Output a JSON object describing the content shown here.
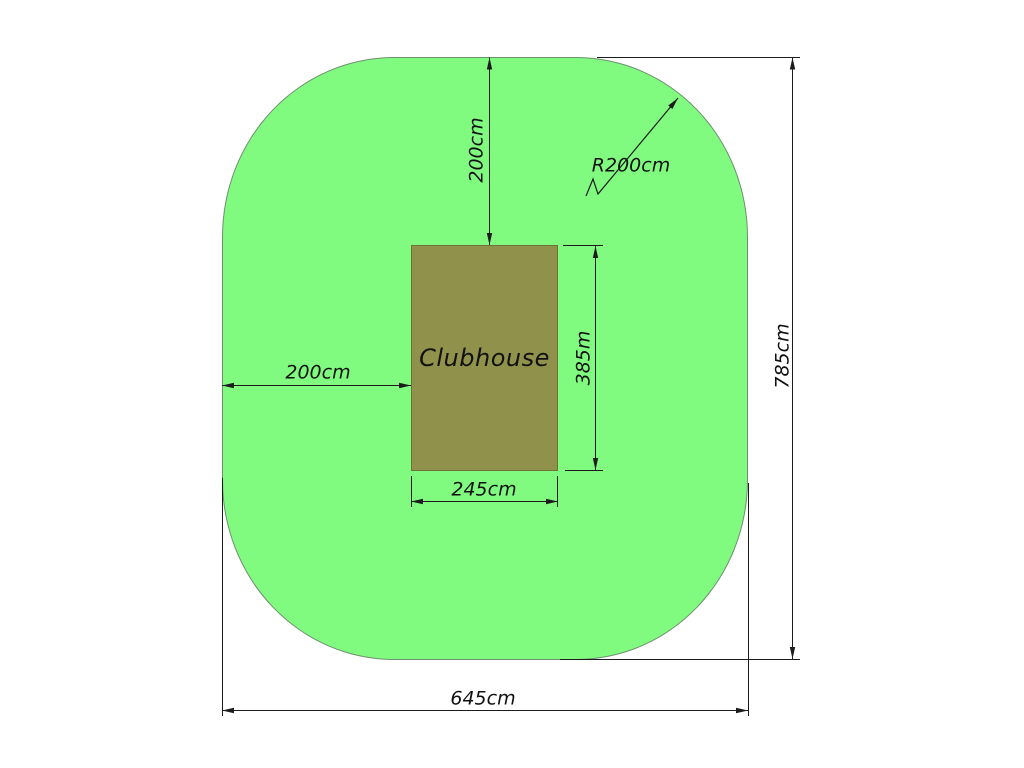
{
  "diagram": {
    "clubhouse_label": "Clubhouse",
    "dimensions": {
      "top_offset": "200cm",
      "corner_radius": "R200cm",
      "overall_height": "785cm",
      "left_offset": "200cm",
      "clubhouse_height": "385m",
      "clubhouse_width": "245cm",
      "overall_width": "645cm"
    },
    "colors": {
      "site_fill": "#80fb80",
      "site_outline": "#6e8f6e",
      "clubhouse_fill": "#90914a",
      "clubhouse_outline": "#70713a",
      "line": "#1c1c1c"
    }
  }
}
